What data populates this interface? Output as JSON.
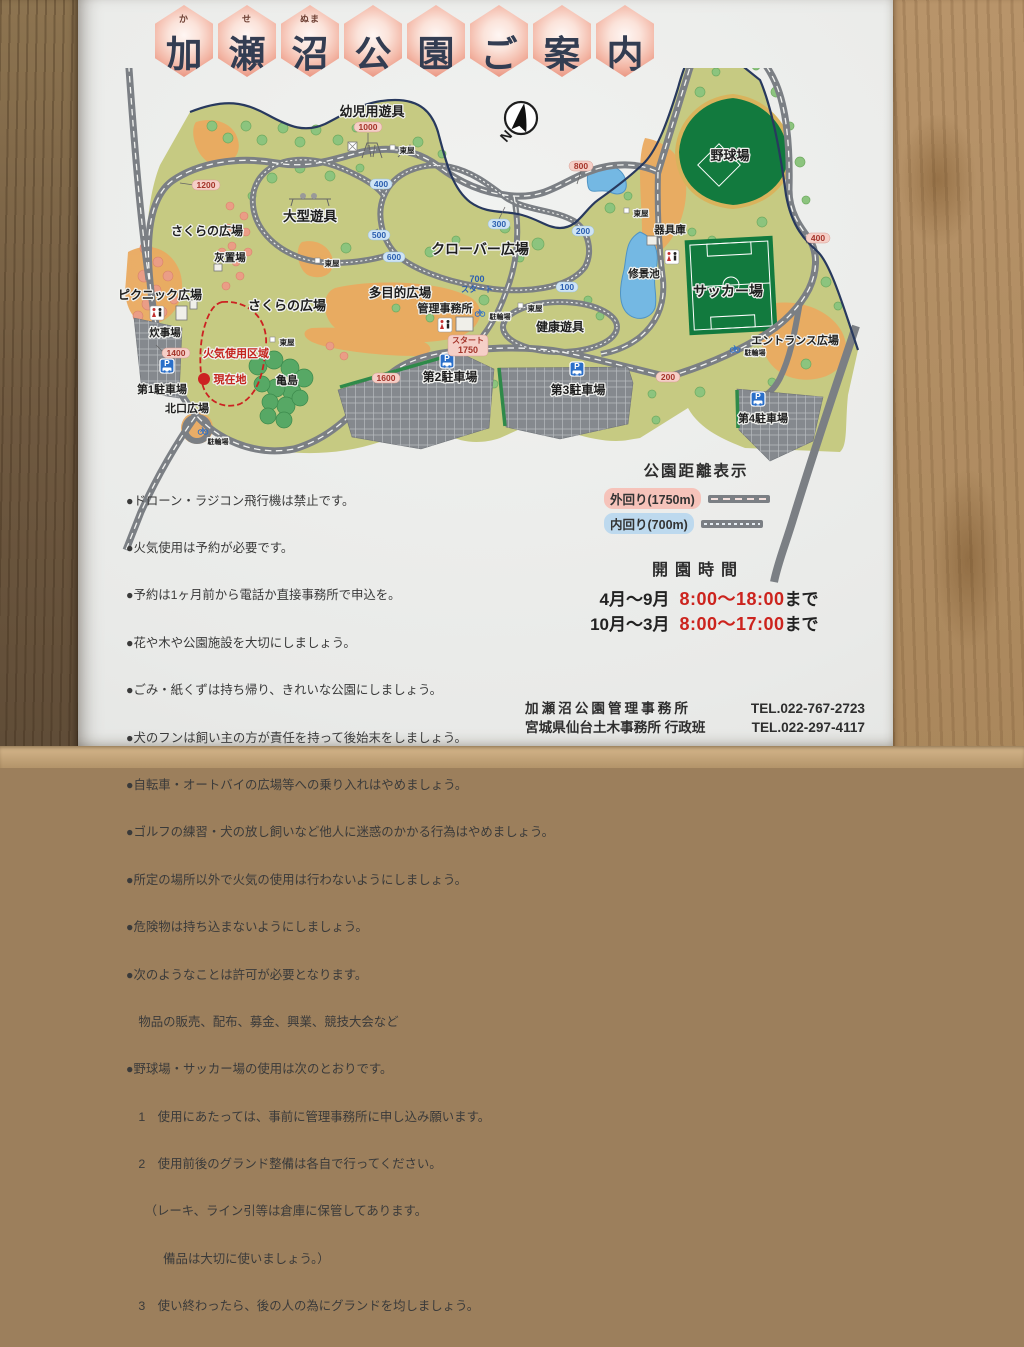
{
  "title": {
    "hexagons": [
      {
        "char": "加",
        "furigana": "か"
      },
      {
        "char": "瀬",
        "furigana": "せ"
      },
      {
        "char": "沼",
        "furigana": "ぬま"
      },
      {
        "char": "公",
        "furigana": ""
      },
      {
        "char": "園",
        "furigana": ""
      },
      {
        "char": "ご",
        "furigana": ""
      },
      {
        "char": "案",
        "furigana": ""
      },
      {
        "char": "内",
        "furigana": ""
      }
    ]
  },
  "map": {
    "compass": "N",
    "labels": {
      "yoji_yugu": "幼児用遊具",
      "ogata_yugu": "大型遊具",
      "sakura_hiroba_upper": "さくらの広場",
      "haiokiba": "灰置場",
      "picnic_hiroba": "ピクニック広場",
      "sakura_hiroba_lower": "さくらの広場",
      "tamokuteki_hiroba": "多目的広場",
      "clover_hiroba": "クローバー広場",
      "kanri_jimusho": "管理事務所",
      "kenko_yugu": "健康遊具",
      "yakyujo": "野球場",
      "kiguko": "器具庫",
      "shukeiike": "修景池",
      "soccerjo": "サッカー場",
      "entrance_hiroba": "エントランス広場",
      "suijiba": "炊事場",
      "kaki_shiyo_kuiki": "火気使用区域",
      "genzaichi": "現在地",
      "kamejima": "亀島",
      "parking1": "第1駐車場",
      "kitaguchi_hiroba": "北口広場",
      "parking2": "第2駐車場",
      "parking3": "第3駐車場",
      "parking4": "第4駐車場"
    },
    "small": {
      "azumaya": "東屋",
      "churinjo": "駐輪場",
      "parking_p": "P"
    },
    "outer_markers": [
      "200",
      "400",
      "600",
      "800",
      "1000",
      "1200",
      "1400",
      "1600"
    ],
    "inner_markers": [
      "100",
      "200",
      "300",
      "400",
      "500",
      "600"
    ],
    "start_outer": {
      "top": "スタート",
      "bottom": "1750"
    },
    "start_inner": {
      "top": "700",
      "bottom": "スタート"
    }
  },
  "rules": [
    "●ドローン・ラジコン飛行機は禁止です。",
    "●火気使用は予約が必要です。",
    "●予約は1ヶ月前から電話か直接事務所で申込を。",
    "●花や木や公園施設を大切にしましょう。",
    "●ごみ・紙くずは持ち帰り、きれいな公園にしましょう。",
    "●犬のフンは飼い主の方が責任を持って後始末をしましょう。",
    "●自転車・オートバイの広場等への乗り入れはやめましょう。",
    "●ゴルフの練習・犬の放し飼いなど他人に迷惑のかかる行為はやめましょう。",
    "●所定の場所以外で火気の使用は行わないようにしましょう。",
    "●危険物は持ち込まないようにしましょう。",
    "●次のようなことは許可が必要となります。",
    "　物品の販売、配布、募金、興業、競技大会など",
    "●野球場・サッカー場の使用は次のとおりです。",
    "　1　使用にあたっては、事前に管理事務所に申し込み願います。",
    "　2　使用前後のグランド整備は各自で行ってください。",
    "　　（レーキ、ライン引等は倉庫に保管してあります。",
    "　　　備品は大切に使いましょう。）",
    "　3　使い終わったら、後の人の為にグランドを均しましょう。"
  ],
  "legend": {
    "title": "公園距離表示",
    "outer_label": "外回り(1750m)",
    "inner_label": "内回り(700m)"
  },
  "hours": {
    "title": "開園時間",
    "rows": [
      {
        "period": "4月〜9月",
        "time": "8:00〜18:00",
        "suffix": "まで"
      },
      {
        "period": "10月〜3月",
        "time": "8:00〜17:00",
        "suffix": "まで"
      }
    ]
  },
  "contact": {
    "line1": {
      "name": "加瀬沼公園管理事務所",
      "tel": "TEL.022-767-2723"
    },
    "line2": {
      "name": "宮城県仙台土木事務所 行政班",
      "tel": "TEL.022-297-4117"
    }
  },
  "colors": {
    "hex_pink": "#e9937f",
    "marker_red": "#a4342a",
    "marker_blue": "#2b5fb0",
    "fire_red": "#cc2222",
    "time_red": "#cc241e",
    "park_green": "#c6ca82",
    "field_green": "#127a3e",
    "pond_blue": "#74b8e3",
    "road_gray": "#7b7f84",
    "plaza_orange": "#eaaa60"
  }
}
